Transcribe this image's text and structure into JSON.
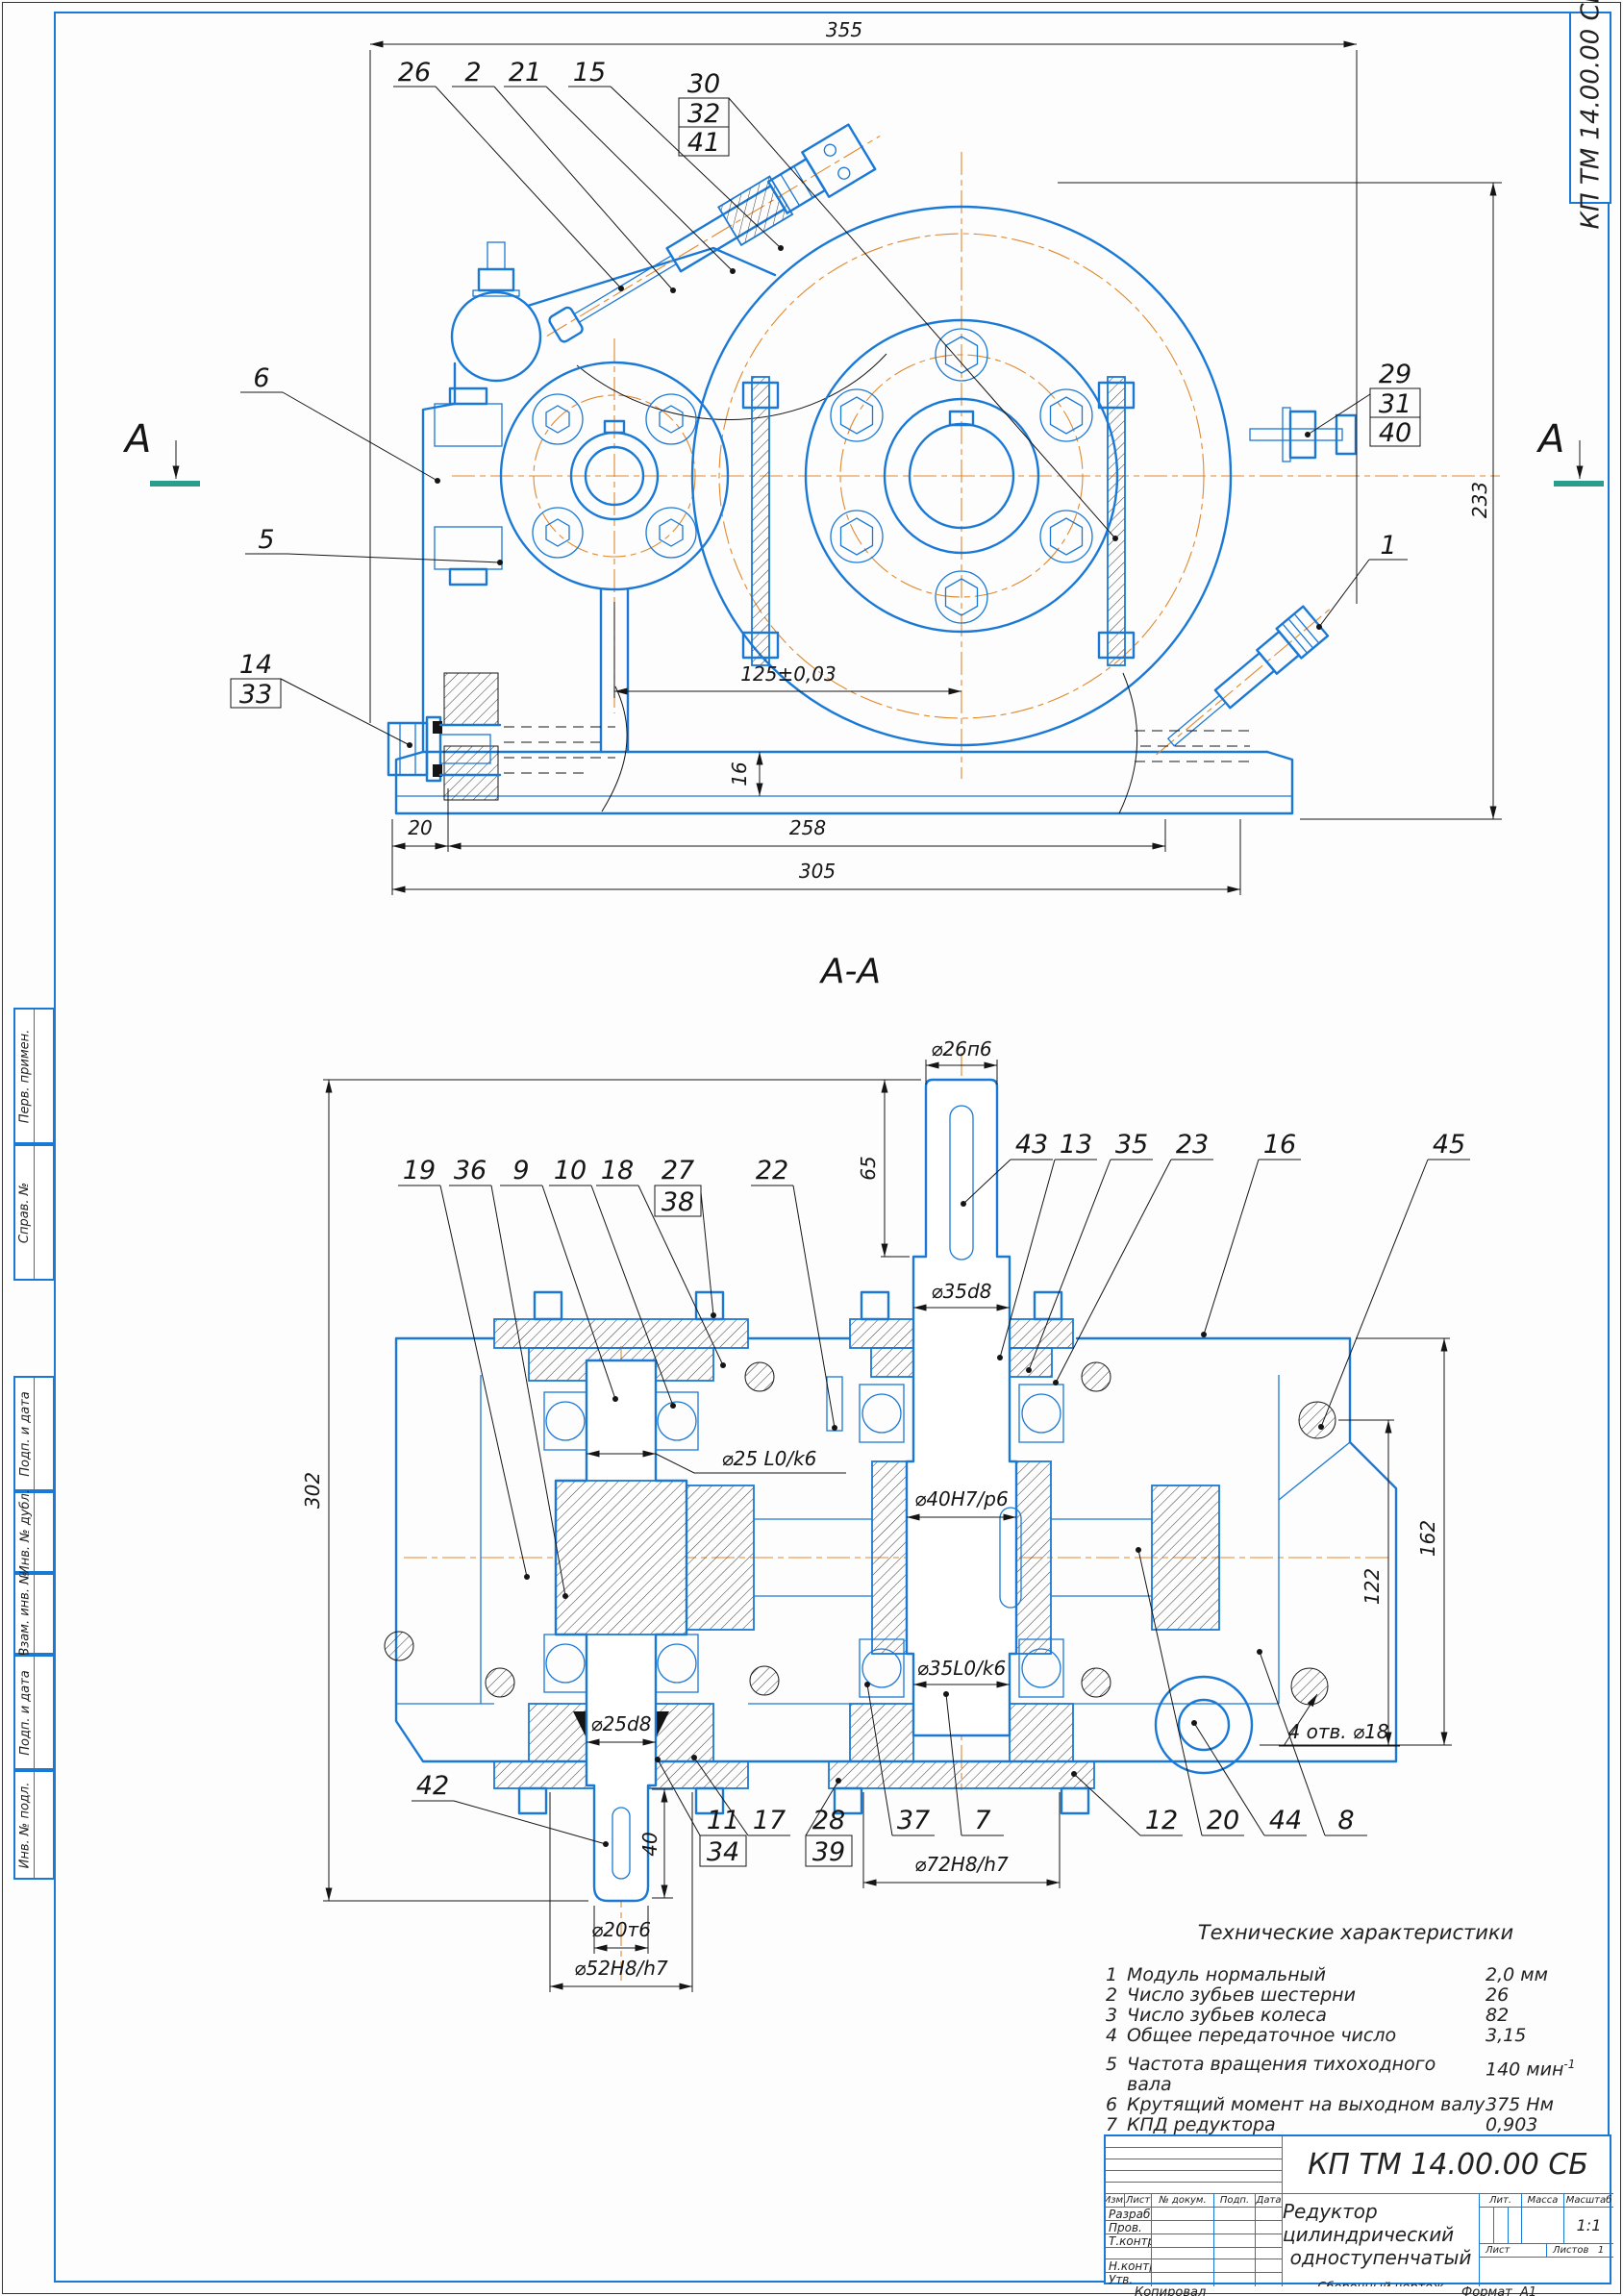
{
  "frame": {
    "corner_stamp": "КП ТМ 14.00.00 СБ",
    "kopiroval": "Копировал",
    "format_label": "Формат",
    "format_value": "А1",
    "side_upper": [
      {
        "label": "Перв. примен."
      },
      {
        "label": "Справ. №"
      }
    ],
    "side_lower": [
      {
        "label": "Подп. и дата"
      },
      {
        "label": "Инв. № дубл."
      },
      {
        "label": "Взам. инв. №"
      },
      {
        "label": "Подп. и дата"
      },
      {
        "label": "Инв. № подл."
      }
    ]
  },
  "view1": {
    "section_letter": "А",
    "dims": {
      "d355": "355",
      "d233": "233",
      "d125": "125±0,03",
      "d16": "16",
      "d20": "20",
      "d258": "258",
      "d305": "305"
    },
    "callouts": {
      "c26": "26",
      "c2": "2",
      "c21": "21",
      "c15": "15",
      "c30": "30",
      "c32": "32",
      "c41": "41",
      "c6": "6",
      "c5": "5",
      "c14": "14",
      "c33": "33",
      "c29": "29",
      "c31": "31",
      "c40": "40",
      "c1": "1"
    }
  },
  "section_title": "А-А",
  "view2": {
    "dims": {
      "d26": "⌀26п6",
      "d65": "65",
      "d35d8": "⌀35d8",
      "d302": "302",
      "d25lk": "⌀25 L0/k6",
      "d40hp": "⌀40H7/p6",
      "d35lk": "⌀35L0/k6",
      "d25d8": "⌀25d8",
      "d40": "40",
      "d20": "⌀20т6",
      "d52": "⌀52H8/h7",
      "d72": "⌀72H8/h7",
      "d122": "122",
      "d162": "162",
      "holes": "4 отв. ⌀18"
    },
    "callouts": {
      "c19": "19",
      "c36": "36",
      "c9": "9",
      "c10": "10",
      "c18": "18",
      "c27": "27",
      "c38": "38",
      "c22": "22",
      "c43": "43",
      "c13": "13",
      "c35": "35",
      "c23": "23",
      "c16": "16",
      "c45": "45",
      "c42": "42",
      "c11": "11",
      "c34": "34",
      "c17": "17",
      "c28": "28",
      "c39": "39",
      "c37": "37",
      "c7": "7",
      "c12": "12",
      "c20": "20",
      "c44": "44",
      "c8": "8"
    }
  },
  "tech": {
    "title": "Технические характеристики",
    "rows": [
      {
        "n": "1",
        "name": "Модуль нормальный",
        "value": "2,0 мм",
        "sup": ""
      },
      {
        "n": "2",
        "name": "Число зубьев шестерни",
        "value": "26",
        "sup": ""
      },
      {
        "n": "3",
        "name": "Число зубьев колеса",
        "value": "82",
        "sup": ""
      },
      {
        "n": "4",
        "name": "Общее передаточное число",
        "value": "3,15",
        "sup": ""
      },
      {
        "n": "5",
        "name": "Частота вращения тихоходного вала",
        "value": "140 мин",
        "sup": "-1"
      },
      {
        "n": "6",
        "name": "Крутящий момент на выходном валу",
        "value": "375 Нм",
        "sup": ""
      },
      {
        "n": "7",
        "name": "КПД редуктора",
        "value": "0,903",
        "sup": ""
      }
    ]
  },
  "title_block": {
    "doc_number": "КП ТМ 14.00.00 СБ",
    "name_line1": "Редуктор цилиндрический",
    "name_line2": "одноступенчатый",
    "doc_type": "Сборочный чертеж",
    "cols": {
      "izm": "Изм.",
      "list": "Лист",
      "ndoc": "№ докум.",
      "podp": "Подп.",
      "data": "Дата"
    },
    "rows": {
      "razrab": "Разраб.",
      "prov": "Пров.",
      "tkontr": "Т.контр.",
      "nkontr": "Н.контр.",
      "utv": "Утв."
    },
    "right": {
      "lit": "Лит.",
      "massa": "Масса",
      "masshtab": "Масштаб",
      "scale": "1:1",
      "list": "Лист",
      "listov": "Листов",
      "listov_val": "1"
    }
  }
}
